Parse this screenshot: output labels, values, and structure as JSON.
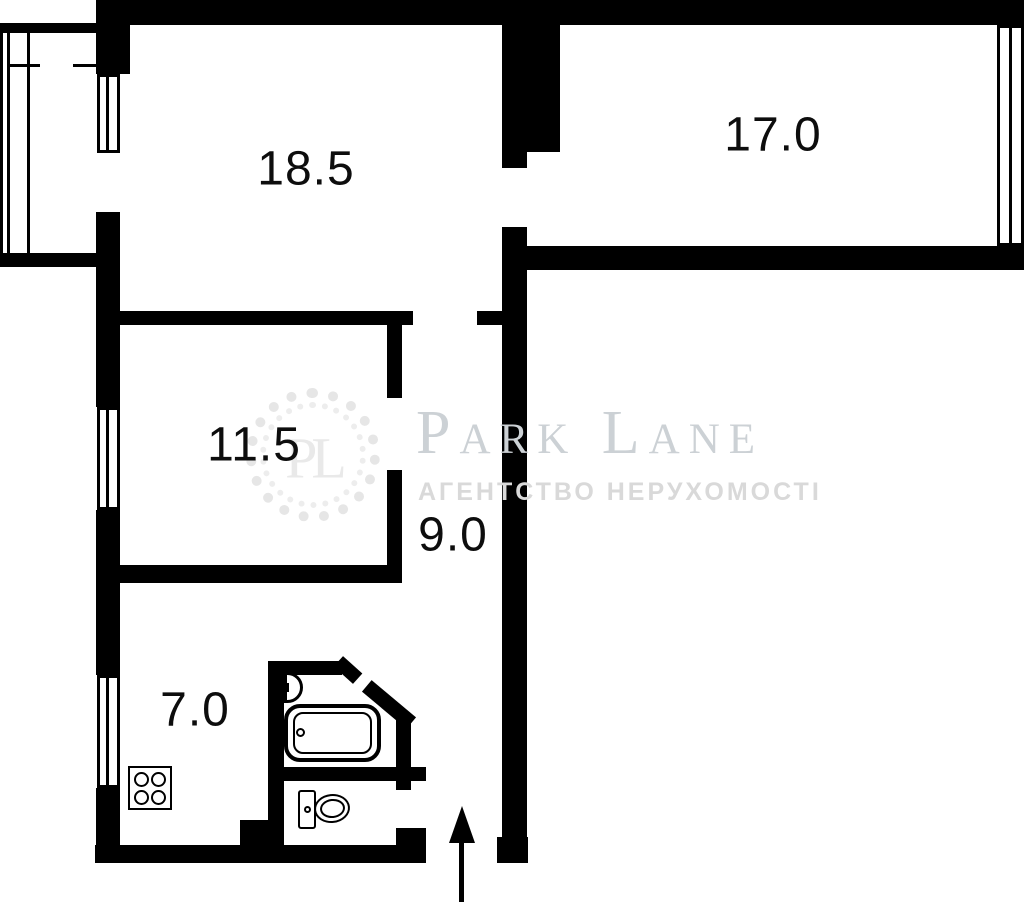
{
  "plan": {
    "title": "apartment-floor-plan",
    "rooms": [
      {
        "name": "living-room",
        "area_label": "18.5"
      },
      {
        "name": "bedroom",
        "area_label": "17.0"
      },
      {
        "name": "room",
        "area_label": "11.5"
      },
      {
        "name": "hallway",
        "area_label": "9.0"
      },
      {
        "name": "kitchen",
        "area_label": "7.0"
      }
    ],
    "features": [
      "balcony",
      "three-windows-left",
      "window-right",
      "entrance-bottom"
    ]
  },
  "watermark": {
    "monogram": "PL",
    "brand": "Park Lane",
    "tagline": "АГЕНТСТВО НЕРУХОМОСТІ"
  },
  "icons": [
    "bathtub-icon",
    "toilet-icon",
    "sink-icon",
    "stove-icon",
    "entrance-arrow-icon",
    "laurel-wreath-icon"
  ],
  "colors": {
    "wall": "#000000",
    "background": "#ffffff",
    "label": "#0d0d0d",
    "watermark_brand": "#ccd1d5",
    "watermark_tagline": "#d9d9d9",
    "watermark_wreath": "#e6e6e6"
  }
}
